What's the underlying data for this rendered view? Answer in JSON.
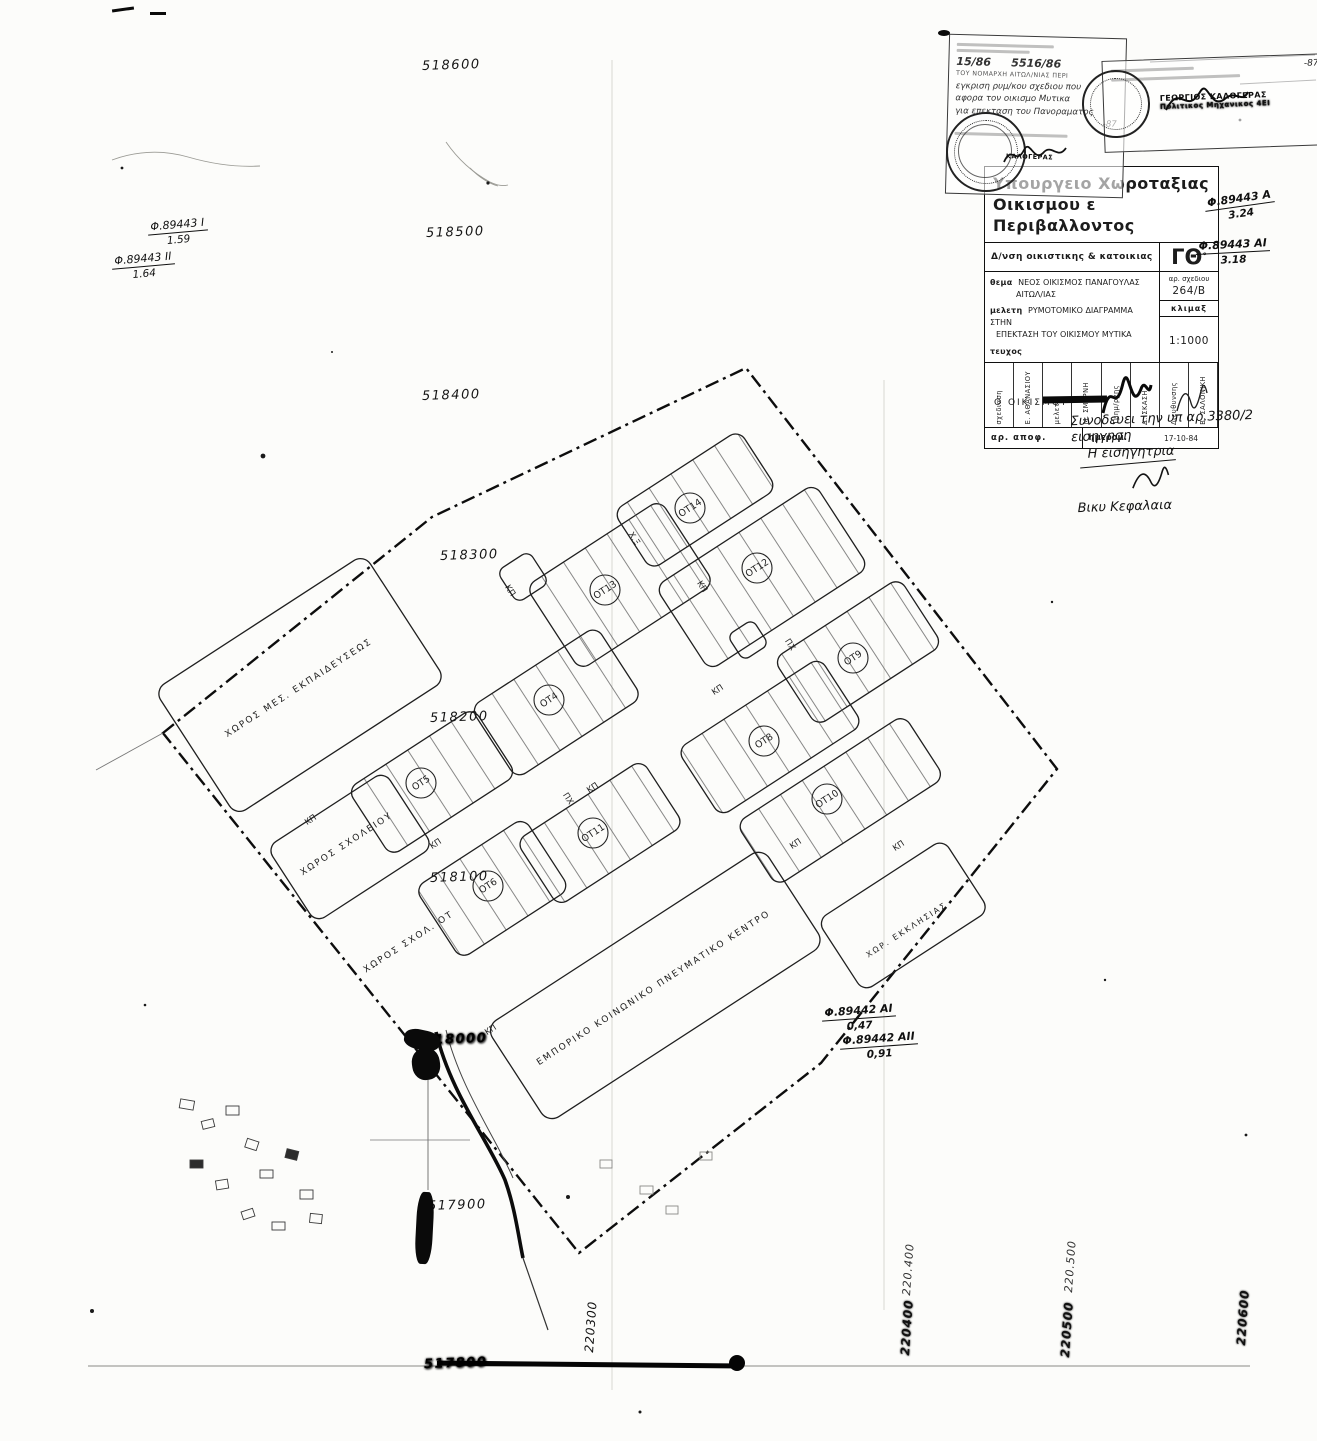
{
  "page": {
    "background": "#fcfcfa",
    "ink": "#1c1c1c"
  },
  "title_block": {
    "ministry_line1": "Υπουργειο  Χωροταξιας",
    "ministry_line2": "Οικισμου ε Περιβαλλοντος",
    "directorate": "Δ/νση  οικιστικης  &  κατοικιας",
    "code": "ΓΘ",
    "code_sup": "°",
    "subject_label": "θεμα",
    "subject_line1": "ΝΕΟΣ  ΟΙΚΙΣΜΟΣ  ΠΑΝΑΓΟΥΛΑΣ",
    "subject_line2": "ΑΙΤΩΛ/ΙΑΣ",
    "study_label": "μελετη",
    "study_line1": "ΡΥΜΟΤΟΜΙΚΟ  ΔΙΑΓΡΑΜΜΑ  ΣΤΗΝ",
    "study_line2": "ΕΠΕΚΤΑΣΗ  ΤΟΥ  ΟΙΚΙΣΜΟΥ   ΜΥΤΙΚΑ",
    "issue_label": "τευχος",
    "drawing_no_label": "αρ. σχεδιου",
    "drawing_no": "264/Β",
    "scale_label": "κλιμαξ",
    "scale": "1:1000",
    "signature_roles": [
      "σχεδιαση",
      "Ε. ΑΘΑΝΑΣΙΟΥ",
      "μελετη",
      "Μ. ΣΜΕΡΝΗ",
      "Τμημ/ρχης",
      "Δ. ΣΚΑΣΗ",
      "Διευθυνσης",
      "Β. ΣΑΛΟΝΙΚΗ"
    ],
    "decision_label": "αρ. αποφ.",
    "date_label": "ημερομ.",
    "date": "17-10-84",
    "footer": "Ο  ΟΙΚΙΣΜΟΥ"
  },
  "stamps": {
    "left": {
      "num1": "15/86",
      "num2": "5516/86",
      "caps_line": "ΤΟΥ ΝΟΜΑΡΧΗ ΑΙΤΩΛ/ΝΙΑΣ ΠΕΡΙ",
      "hand1": "εγκριση ρυμ/κου σχεδιου που",
      "hand2": "αφορα τον οικισμο Μυτικα",
      "hand3": "για επεκταση του Πανοραματος",
      "date": "-87",
      "seal_name": "ΚΑΛΟΓΕΡΑΣ"
    },
    "right": {
      "date": "-87",
      "name": "ΓΕΩΡΓΙΟΣ  ΚΑΛΟΓΕΡΑΣ",
      "title": "Πολιτικος Μηχανικος 4ΕΙ"
    }
  },
  "notes": {
    "right_note": [
      "Συνοδευει την υπ αρ.3380/2 εισηγηση",
      "Η εισηγητρια",
      "Βικυ Κεφαλαια"
    ],
    "refs": {
      "tr1n": "Φ.89443 Α",
      "tr1d": "3.24",
      "tr2n": "Φ.89443 ΑΙ",
      "tr2d": "3.18",
      "l1n": "Φ.89443 Ι",
      "l1d": "1.59",
      "l2n": "Φ.89443 ΙΙ",
      "l2d": "1.64",
      "br1n": "Φ.89442 ΑΙ",
      "br1d": "0,47",
      "br2n": "Φ.89442 ΑΙΙ",
      "br2d": "0,91"
    }
  },
  "grid": {
    "northings": [
      "518600",
      "518500",
      "518400",
      "518300",
      "518200",
      "518100",
      "518000",
      "517900",
      "517800"
    ],
    "eastings": [
      "220300",
      "220400",
      "220500",
      "220600"
    ],
    "eastings_hand": [
      "220.400",
      "220.500"
    ]
  },
  "map": {
    "ot_labels": [
      "ΟΤ14",
      "ΟΤ13",
      "ΟΤ12",
      "ΟΤ9",
      "ΟΤ4",
      "ΟΤ8",
      "ΟΤ5",
      "ΟΤ10",
      "ΟΤ11",
      "ΟΤ6"
    ],
    "street_label": "ΚΠ",
    "park_label": "ΠΧ",
    "xe_label": "Χ.Ξ",
    "areas": {
      "education": "ΧΩΡΟΣ ΜΕΣ. ΕΚΠΑΙΔΕΥΣΕΩΣ",
      "school1": "ΧΩΡΟΣ ΣΧΟΛΕΙΟΥ",
      "school2": "ΧΩΡΟΣ ΣΧΟΛ. ΟΤ",
      "center": "ΕΜΠΟΡΙΚΟ ΚΟΙΝΩΝΙΚΟ ΠΝΕΥΜΑΤΙΚΟ ΚΕΝΤΡΟ",
      "church": "ΧΩΡ. ΕΚΚΛΗΣΙΑΣ"
    }
  }
}
